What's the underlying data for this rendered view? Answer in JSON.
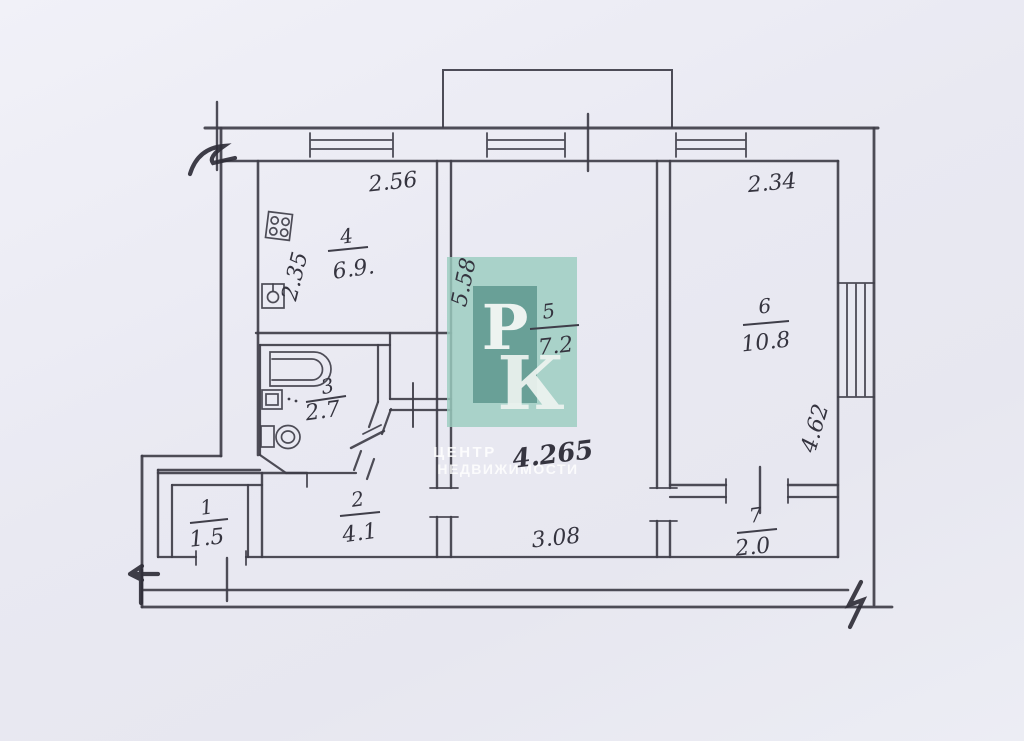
{
  "plan": {
    "dimensions": {
      "kitchen_width": "2.56",
      "room6_width": "2.34",
      "kitchen_depth": "2.35",
      "room5_depth": "5.58",
      "room6_depth": "4.62",
      "room5_width": "4.265",
      "room5_width_bottom": "3.08"
    },
    "rooms": {
      "kitchen": {
        "number": "4",
        "area": "6.9."
      },
      "room5": {
        "number": "5",
        "area": "7.2"
      },
      "room6": {
        "number": "6",
        "area": "10.8"
      },
      "bathroom": {
        "number": "3",
        "area": "2.7"
      },
      "hallway": {
        "number": "2",
        "area": "4.1"
      },
      "entry": {
        "number": "1",
        "area": "1.5"
      },
      "corridor": {
        "number": "7",
        "area": "2.0"
      }
    }
  },
  "watermark": {
    "letter_p": "Р",
    "letter_k": "К",
    "caption_line1": "ЦЕНТР",
    "caption_line2": "НЕДВИЖИМОСТИ",
    "square_color": "#9bcdbf",
    "badge_color": "#5d968e"
  },
  "colors": {
    "paper": "#e9e9f2",
    "ink": "#3a3944"
  }
}
